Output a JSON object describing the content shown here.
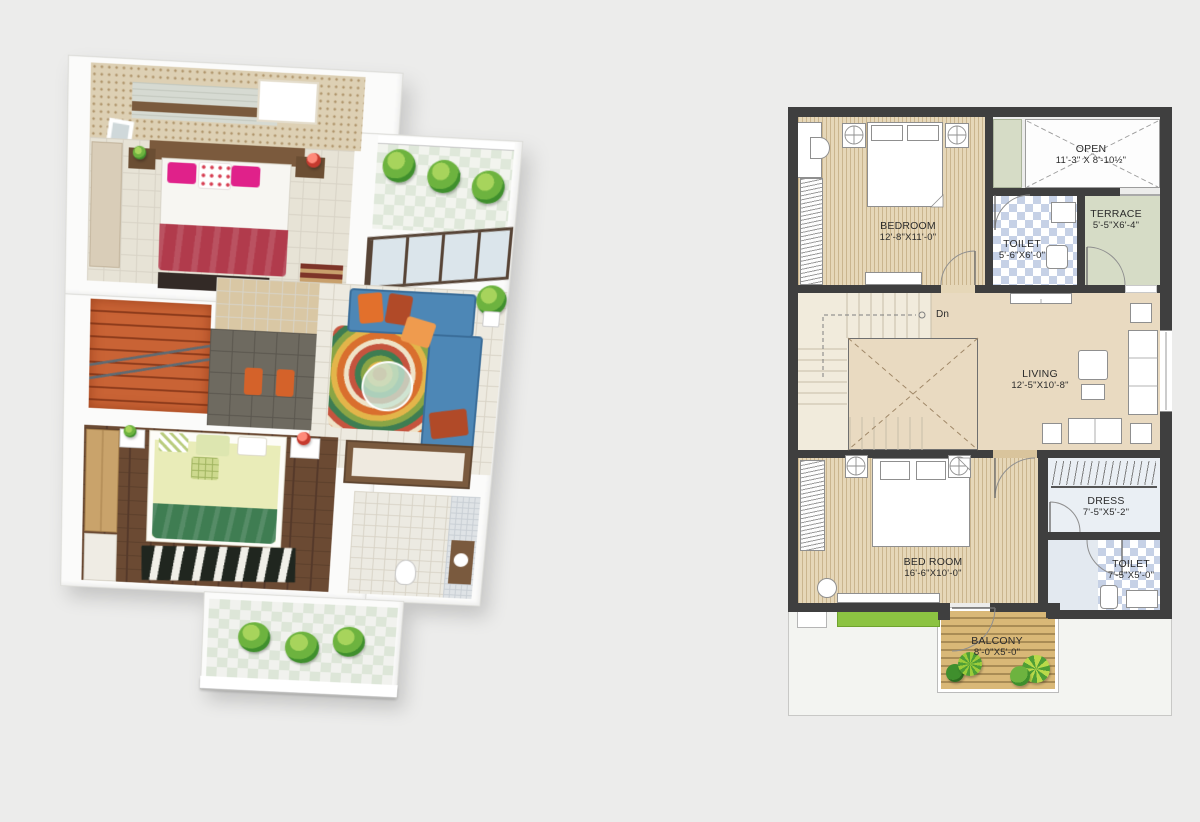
{
  "page": {
    "background": "#ececeb"
  },
  "plan2d": {
    "rooms": [
      {
        "key": "bedroom-1",
        "name": "BEDROOM",
        "dims": "12'-8\"X11'-0\""
      },
      {
        "key": "open",
        "name": "OPEN",
        "dims": "11'-3\" X 8'-10½\""
      },
      {
        "key": "toilet-1",
        "name": "TOILET",
        "dims": "5'-6\"X6'-0\""
      },
      {
        "key": "terrace",
        "name": "TERRACE",
        "dims": "5'-5\"X6'-4\""
      },
      {
        "key": "living",
        "name": "LIVING",
        "dims": "12'-5\"X10'-8\""
      },
      {
        "key": "bed-room-2",
        "name": "BED ROOM",
        "dims": "16'-6\"X10'-0\""
      },
      {
        "key": "dress",
        "name": "DRESS",
        "dims": "7'-5\"X5'-2\""
      },
      {
        "key": "toilet-2",
        "name": "TOILET",
        "dims": "7'-5\"X5'-0\""
      },
      {
        "key": "balcony",
        "name": "BALCONY",
        "dims": "8'-0\"X5'-0\""
      }
    ],
    "stairs": {
      "down_label": "Dn"
    },
    "palette": {
      "wall": "#3f3f3f",
      "bedroom_floor": "#e6d7b8",
      "living_floor": "#e9dac1",
      "stair_floor": "#f1ebdc",
      "toilet_tile": "#c6d1e6",
      "terrace_floor": "#d6dcc6",
      "open_floor": "#fdfdfd",
      "dress_floor": "#eaeff4",
      "balcony_deck": "#d9b877",
      "planter_green": "#8cc342",
      "page_background": "#ececeb"
    }
  },
  "plan3d": {
    "palette": {
      "sofa_blue": "#4d87b6",
      "cushion_orange": "#e2702c",
      "cushion_rust": "#b14a28",
      "bed1_pillow_pink": "#e0218a",
      "bed1_blanket_red": "#b13b4c",
      "bed2_sheet_green": "#e9ecb8",
      "bed2_blanket_green": "#3f7d52",
      "stairs_terracotta": "#c96335",
      "wood_floor_brown": "#6b4a33",
      "accent_wall_beige": "#ddd0b4",
      "plant_green": "#6db33f"
    }
  }
}
